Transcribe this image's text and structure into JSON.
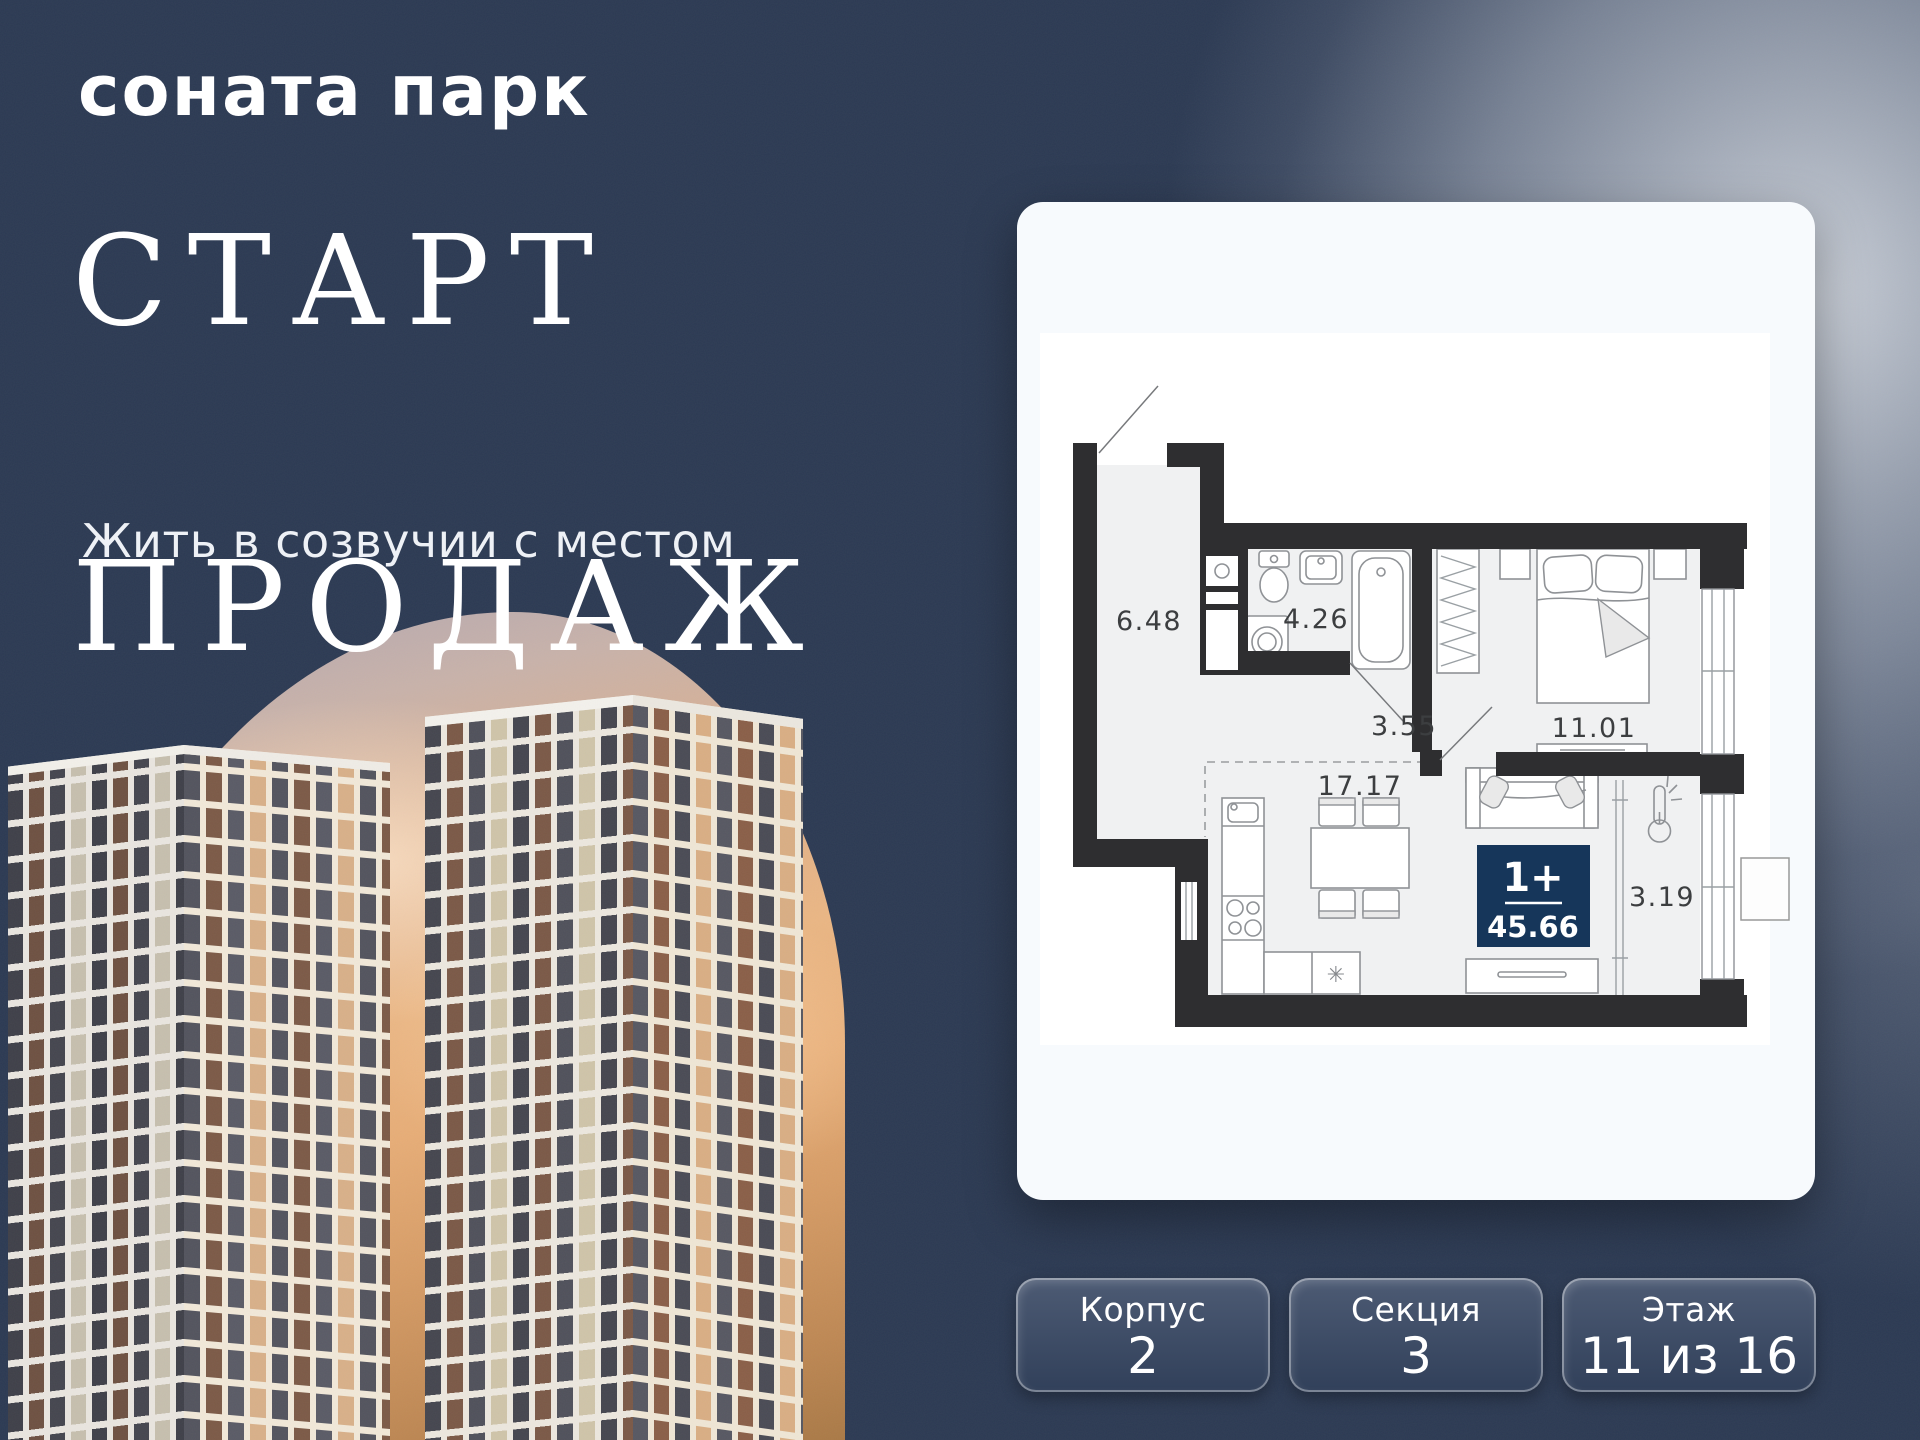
{
  "brand": {
    "logo_text": "соната парк"
  },
  "hero": {
    "title_line1": "СТАРТ",
    "title_line2": "ПРОДАЖ",
    "subtitle": "Жить в созвучии с местом"
  },
  "floorplan": {
    "rooms": [
      {
        "id": "hallway",
        "area": "6.48"
      },
      {
        "id": "bathroom",
        "area": "4.26"
      },
      {
        "id": "corridor",
        "area": "3.55"
      },
      {
        "id": "kitchen-living",
        "area": "17.17"
      },
      {
        "id": "bedroom",
        "area": "11.01"
      },
      {
        "id": "balcony",
        "area": "3.19"
      }
    ],
    "badge": {
      "layout": "1+",
      "total_area": "45.66"
    },
    "icons": {
      "fridge_glyph": "✳"
    }
  },
  "details": [
    {
      "label": "Корпус",
      "value": "2"
    },
    {
      "label": "Секция",
      "value": "3"
    },
    {
      "label": "Этаж",
      "value": "11 из 16"
    }
  ],
  "colors": {
    "background": "#2c3a53",
    "card": "#f7fafd",
    "badge": "#16365a",
    "wall": "#2e2e30",
    "sunset_peach": "#eab684",
    "detail_box_top": "#4d5b74",
    "detail_box_bottom": "#31405a"
  }
}
